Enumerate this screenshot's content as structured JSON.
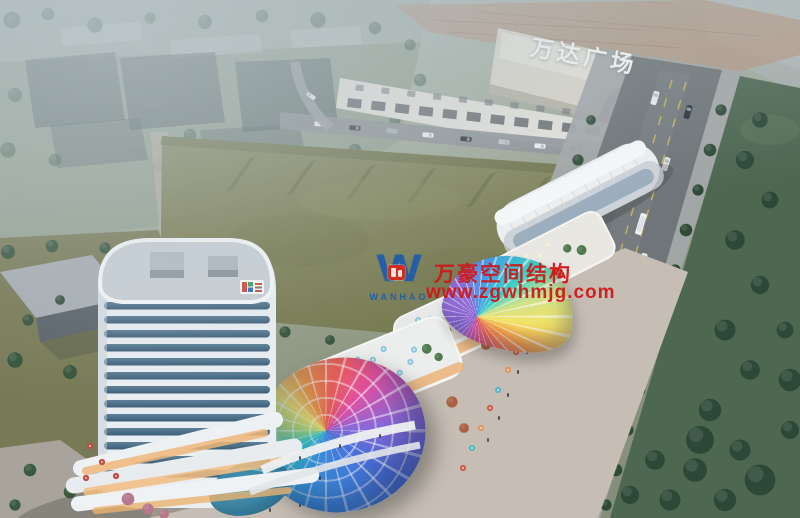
{
  "scene": {
    "wanda_plaza": {
      "sign": "万达广场",
      "sign_color": "#fbfbf8"
    },
    "watermark": {
      "company": "万豪空间结构",
      "website": "www.zgwhmjg.com",
      "logo_text": "WANHAO",
      "logo_letter": "W",
      "red": "#cf1616",
      "blue": "#1e5cab",
      "badge_red": "#d6281c"
    },
    "palette": {
      "haze": "#aebac2",
      "field_green": "#7e8156",
      "asphalt": "#6f7578",
      "tree_green": "#2f4b37",
      "tower_white": "#e9eef2",
      "window_band": "#4f708a",
      "plaza": "#c6bdb4",
      "storefront_glow": "#eeb377",
      "roofscape_tan": "#b59580",
      "pool_teal": "#2e7e94",
      "dome_rainbow": [
        "#3e9ae8",
        "#37d0c4",
        "#f7e463",
        "#f59a3e",
        "#ef5f52",
        "#e14f9e",
        "#8f67d8"
      ]
    }
  }
}
